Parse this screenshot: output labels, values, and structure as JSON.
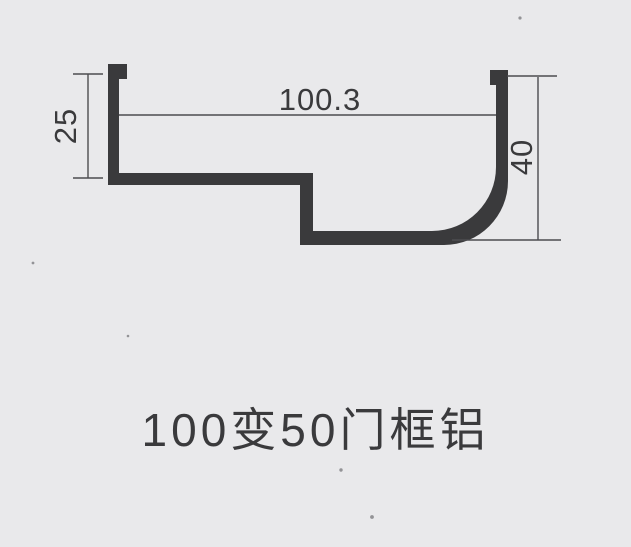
{
  "title": "100变50门框铝",
  "colors": {
    "background": "#e9e9eb",
    "ink": "#3a3a3c",
    "line": "#4c4c50"
  },
  "profile": {
    "name": "aluminum-door-frame-profile-cross-section",
    "path": "M108,64 L127,64 L127,79 L119,79 L119,173 L313,173 L313,231 L432,231 A64,64 0 0 0 496,167 L496,85 L490,85 L490,70 L508,70 L508,181 A64,64 0 0 1 444,245 L300,245 L300,185 L108,185 L108,64 Z"
  },
  "dimensions": {
    "width_top": {
      "label": "100.3"
    },
    "height_left": {
      "label": "25"
    },
    "height_right": {
      "label": "40"
    }
  }
}
